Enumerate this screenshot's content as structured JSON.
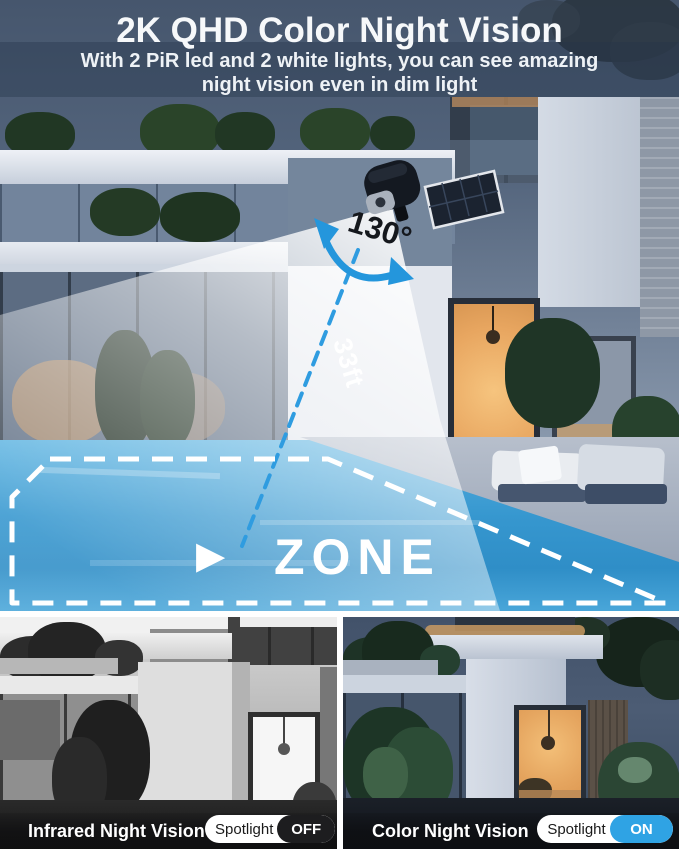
{
  "header": {
    "title": "2K QHD Color Night Vision",
    "subtitle_line1": "With 2 PiR led and 2 white lights, you can see amazing",
    "subtitle_line2": "night vision even in dim light"
  },
  "overlay": {
    "angle_label": "130°",
    "distance_label": "33ft",
    "zone_label": "ZONE",
    "play_icon": "▶",
    "accent_blue": "#2f9ce0",
    "dash_color": "#ffffff"
  },
  "comparison": {
    "left": {
      "caption": "Infrared Night Vision",
      "toggle_label": "Spotlight",
      "toggle_state": "OFF",
      "state_color": "#1d1d1f"
    },
    "right": {
      "caption": "Color Night Vision",
      "toggle_label": "Spotlight",
      "toggle_state": "ON",
      "state_color": "#2fa3e4"
    }
  }
}
